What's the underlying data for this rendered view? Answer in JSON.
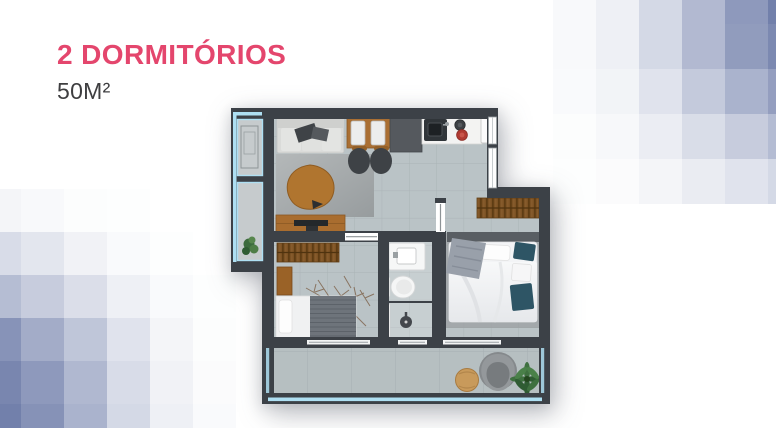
{
  "header": {
    "title": "2 DORMITÓRIOS",
    "subtitle": "50M²"
  },
  "colors": {
    "accent": "#E4466D",
    "subtitle_text": "#3E3E40",
    "mosaic_base": "#6B79A8",
    "wall": "#3C4147",
    "floor_tile": "#BAC3C6",
    "balcony_tile": "#B6BFC1",
    "glass_blue": "#AEDFF2",
    "wood": "#A96D2F",
    "wardrobe_wood": "#7C5224",
    "teal_pillow": "#2E5565",
    "burner_red": "#B03A31",
    "plant_green": "#3F7040",
    "pouf_tan": "#C89A5B"
  },
  "mosaics": {
    "top_right": {
      "x": 553,
      "y": -21,
      "cell_w": 43,
      "cell_h": 45,
      "rgb": "114,128,171",
      "alphas": [
        [
          0.05,
          0.12,
          0.3,
          0.55,
          0.8,
          1.0
        ],
        [
          0.05,
          0.12,
          0.3,
          0.55,
          0.78,
          0.93
        ],
        [
          0.04,
          0.09,
          0.22,
          0.42,
          0.6,
          0.76
        ],
        [
          0.02,
          0.06,
          0.14,
          0.27,
          0.4,
          0.53
        ],
        [
          0.01,
          0.03,
          0.08,
          0.15,
          0.22,
          0.3
        ]
      ]
    },
    "bottom_left": {
      "x": -22,
      "y": 189,
      "cell_w": 43,
      "cell_h": 43,
      "rgb": "114,128,171",
      "alphas": [
        [
          0.08,
          0.05,
          0.02,
          0.01,
          0.0,
          0.0
        ],
        [
          0.28,
          0.2,
          0.1,
          0.04,
          0.01,
          0.0
        ],
        [
          0.52,
          0.4,
          0.26,
          0.12,
          0.04,
          0.01
        ],
        [
          0.85,
          0.65,
          0.45,
          0.22,
          0.08,
          0.02
        ],
        [
          0.95,
          0.8,
          0.56,
          0.28,
          0.1,
          0.03
        ],
        [
          1.0,
          0.86,
          0.6,
          0.3,
          0.12,
          0.04
        ]
      ]
    }
  }
}
